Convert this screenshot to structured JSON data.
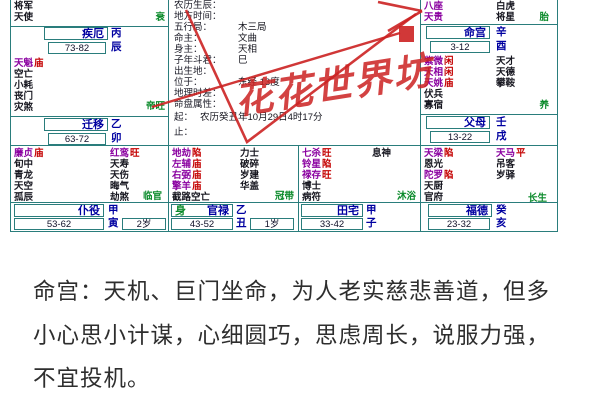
{
  "chart": {
    "colors": {
      "border": "#2a7d7c",
      "palace_name": "#0000a0",
      "star_major": "#8a00a0",
      "star_minor": "#16161f",
      "brightness": "#c40000",
      "stage_green": "#0a8a2a",
      "annotation_red": "#cc2222"
    },
    "watermark": "花花世界坊",
    "info_rows": [
      {
        "label": "农历生辰：",
        "value": ""
      },
      {
        "label": "地方时间：",
        "value": ""
      },
      {
        "label": "五行局：",
        "value": "木三局"
      },
      {
        "label": "命主：",
        "value": "文曲"
      },
      {
        "label": "身主：",
        "value": "天相"
      },
      {
        "label": "子年斗君：",
        "value": "巳"
      },
      {
        "label": "出生地：",
        "value": ""
      },
      {
        "label": "位于：",
        "value": "东经 13度"
      },
      {
        "label": "地理时差：",
        "value": ""
      },
      {
        "label": "命盘属性：",
        "value": ""
      },
      {
        "label": "起：",
        "value": "农历癸丑年10月29日4时17分"
      },
      {
        "label": "止：",
        "value": ""
      }
    ],
    "palaces": {
      "ji_e": {
        "name": "疾厄",
        "stem": "丙",
        "branch": "辰",
        "range": "73-82",
        "stage": "衰",
        "stars_left": [
          {
            "n": "将军",
            "b": ""
          },
          {
            "n": "天使",
            "b": ""
          }
        ],
        "stars_right": []
      },
      "ming_gong": {
        "name": "命宫",
        "stem": "辛",
        "branch": "酉",
        "range": "3-12",
        "stage": "胎",
        "stars_left": [
          {
            "n": "八座",
            "b": ""
          },
          {
            "n": "天贵",
            "b": ""
          }
        ],
        "stars_right": [
          {
            "n": "白虎",
            "b": ""
          },
          {
            "n": "将星",
            "b": ""
          }
        ]
      },
      "qian_yi": {
        "name": "迁移",
        "stem": "乙",
        "branch": "卯",
        "range": "63-72",
        "stage": "帝旺",
        "stars_left": [
          {
            "n": "天魁",
            "b": "庙"
          },
          {
            "n": "空亡",
            "b": ""
          },
          {
            "n": "小耗",
            "b": ""
          },
          {
            "n": "丧门",
            "b": ""
          },
          {
            "n": "灾煞",
            "b": ""
          }
        ],
        "stars_right": []
      },
      "fu_mu": {
        "name": "父母",
        "stem": "壬",
        "branch": "戌",
        "range": "13-22",
        "stage": "养",
        "stars_left": [
          {
            "n": "紫微",
            "b": "闲"
          },
          {
            "n": "天相",
            "b": "闲"
          },
          {
            "n": "天姚",
            "b": "庙"
          },
          {
            "n": "伏兵",
            "b": ""
          },
          {
            "n": "寡宿",
            "b": ""
          }
        ],
        "stars_right": [
          {
            "n": "天才",
            "b": ""
          },
          {
            "n": "天德",
            "b": ""
          },
          {
            "n": "攀鞍",
            "b": ""
          }
        ]
      },
      "pu_yi": {
        "name": "仆役",
        "stem": "甲",
        "branch": "寅",
        "range": "53-62",
        "age": "2岁",
        "stage": "临官",
        "stars_left": [
          {
            "n": "廉贞",
            "b": "庙"
          },
          {
            "n": "旬中",
            "b": ""
          },
          {
            "n": "青龙",
            "b": ""
          },
          {
            "n": "天空",
            "b": ""
          },
          {
            "n": "孤辰",
            "b": ""
          }
        ],
        "stars_right": [
          {
            "n": "红鸾",
            "b": "旺"
          },
          {
            "n": "天寿",
            "b": ""
          },
          {
            "n": "天伤",
            "b": ""
          },
          {
            "n": "晦气",
            "b": ""
          },
          {
            "n": "劫煞",
            "b": ""
          }
        ]
      },
      "guan_lu": {
        "name": "官禄",
        "body_marker": "身",
        "stem": "乙",
        "branch": "丑",
        "range": "43-52",
        "age": "1岁",
        "stage": "冠带",
        "stars_left": [
          {
            "n": "地劫",
            "b": "陷"
          },
          {
            "n": "左辅",
            "b": "庙"
          },
          {
            "n": "右弼",
            "b": "庙"
          },
          {
            "n": "擎羊",
            "b": "庙"
          },
          {
            "n": "截路空亡",
            "b": ""
          }
        ],
        "stars_right": [
          {
            "n": "力士",
            "b": ""
          },
          {
            "n": "破碎",
            "b": ""
          },
          {
            "n": "岁建",
            "b": ""
          },
          {
            "n": "华盖",
            "b": ""
          }
        ]
      },
      "tian_zhai": {
        "name": "田宅",
        "stem": "甲",
        "branch": "子",
        "range": "33-42",
        "stage": "沐浴",
        "stars_left": [
          {
            "n": "七杀",
            "b": "旺"
          },
          {
            "n": "铃星",
            "b": "陷"
          },
          {
            "n": "禄存",
            "b": "旺"
          },
          {
            "n": "博士",
            "b": ""
          },
          {
            "n": "病符",
            "b": ""
          }
        ],
        "stars_right": [
          {
            "n": "息神",
            "b": ""
          }
        ]
      },
      "fu_de": {
        "name": "福德",
        "stem": "癸",
        "branch": "亥",
        "range": "23-32",
        "stage": "长生",
        "stars_left": [
          {
            "n": "天梁",
            "b": "陷"
          },
          {
            "n": "恩光",
            "b": ""
          },
          {
            "n": "陀罗",
            "b": "陷"
          },
          {
            "n": "天厨",
            "b": ""
          },
          {
            "n": "官府",
            "b": ""
          }
        ],
        "stars_right": [
          {
            "n": "天马",
            "b": "平"
          },
          {
            "n": "吊客",
            "b": ""
          },
          {
            "n": "岁驿",
            "b": ""
          }
        ]
      }
    }
  },
  "description": {
    "lines": [
      "命宫：天机、巨门坐命，为人老实慈悲善道，但多",
      "小心思小计谋，心细圆巧，思虑周长，说服力强，",
      "不宜投机。"
    ]
  }
}
